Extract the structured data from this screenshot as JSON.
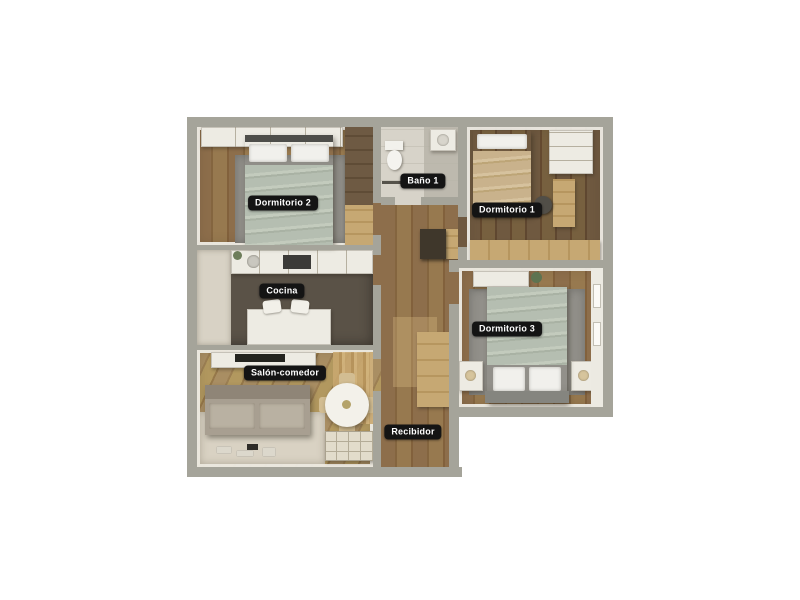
{
  "floorplan": {
    "kind": "3d-apartment-floor-plan",
    "rooms": [
      {
        "id": "dormitorio-2",
        "label": "Dormitorio 2"
      },
      {
        "id": "bano-1",
        "label": "Baño 1"
      },
      {
        "id": "dormitorio-1",
        "label": "Dormitorio 1"
      },
      {
        "id": "cocina",
        "label": "Cocina"
      },
      {
        "id": "dormitorio-3",
        "label": "Dormitorio 3"
      },
      {
        "id": "salon-comedor",
        "label": "Salón-comedor"
      },
      {
        "id": "recibidor",
        "label": "Recibidor"
      }
    ],
    "colors": {
      "background": "#ffffff",
      "wall": "#a5a49a",
      "label_bg": "#141414",
      "label_text": "#ffffff",
      "wood_floor": "#8a6b49",
      "kitchen_floor": "#5a5247",
      "rug": "#92908a",
      "bed_blanket": "#b5beb1"
    }
  }
}
